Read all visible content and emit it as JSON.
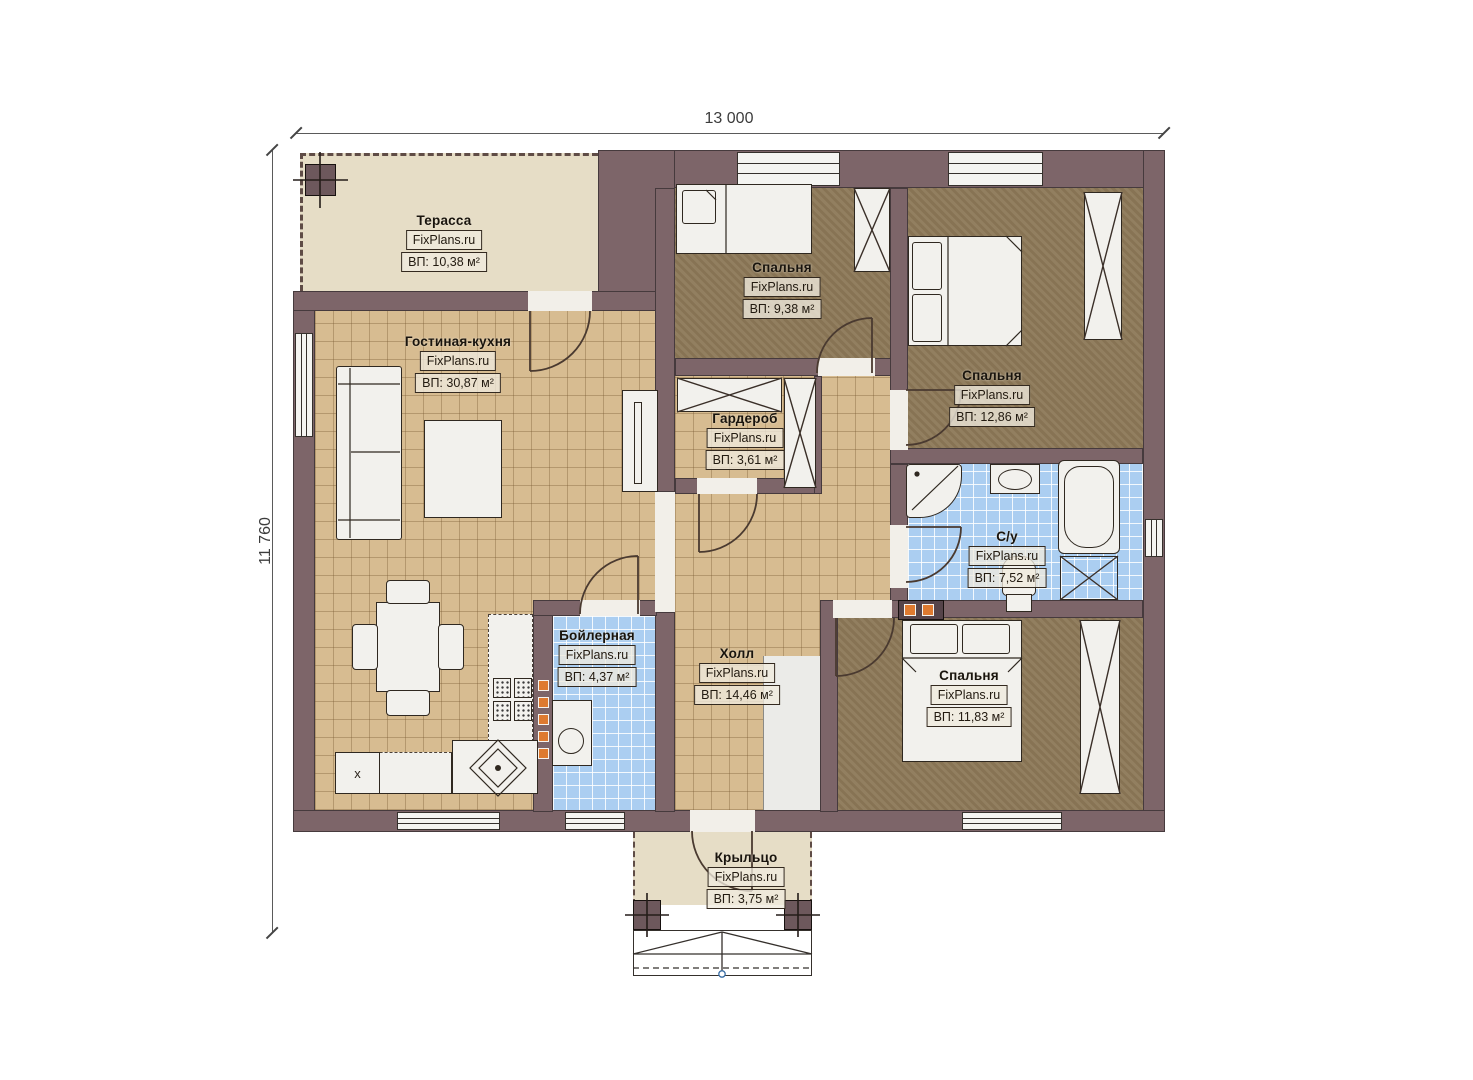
{
  "watermark": "FixPlans.ru",
  "dimensions": {
    "width_label": "13 000",
    "height_label": "11 760"
  },
  "rooms": {
    "terrace": {
      "name": "Терасса",
      "area": "ВП: 10,38 м²"
    },
    "living": {
      "name": "Гостиная-кухня",
      "area": "ВП: 30,87 м²"
    },
    "bedroom1": {
      "name": "Спальня",
      "area": "ВП: 9,38 м²"
    },
    "bedroom2": {
      "name": "Спальня",
      "area": "ВП: 12,86 м²"
    },
    "wardrobe": {
      "name": "Гардероб",
      "area": "ВП: 3,61 м²"
    },
    "bathroom": {
      "name": "С/у",
      "area": "ВП: 7,52 м²"
    },
    "boiler": {
      "name": "Бойлерная",
      "area": "ВП: 4,37 м²"
    },
    "hall": {
      "name": "Холл",
      "area": "ВП: 14,46 м²"
    },
    "bedroom3": {
      "name": "Спальня",
      "area": "ВП: 11,83 м²"
    },
    "porch": {
      "name": "Крыльцо",
      "area": "ВП: 3,75 м²"
    }
  },
  "kitchen_marker": "x",
  "colors": {
    "wall": "#7d6569",
    "floor_living": "#d7bc91",
    "floor_bedroom": "#8c7857",
    "floor_wet": "#abcef1",
    "floor_outdoor": "#e6ddc6",
    "accent_orange": "#de7a30"
  }
}
